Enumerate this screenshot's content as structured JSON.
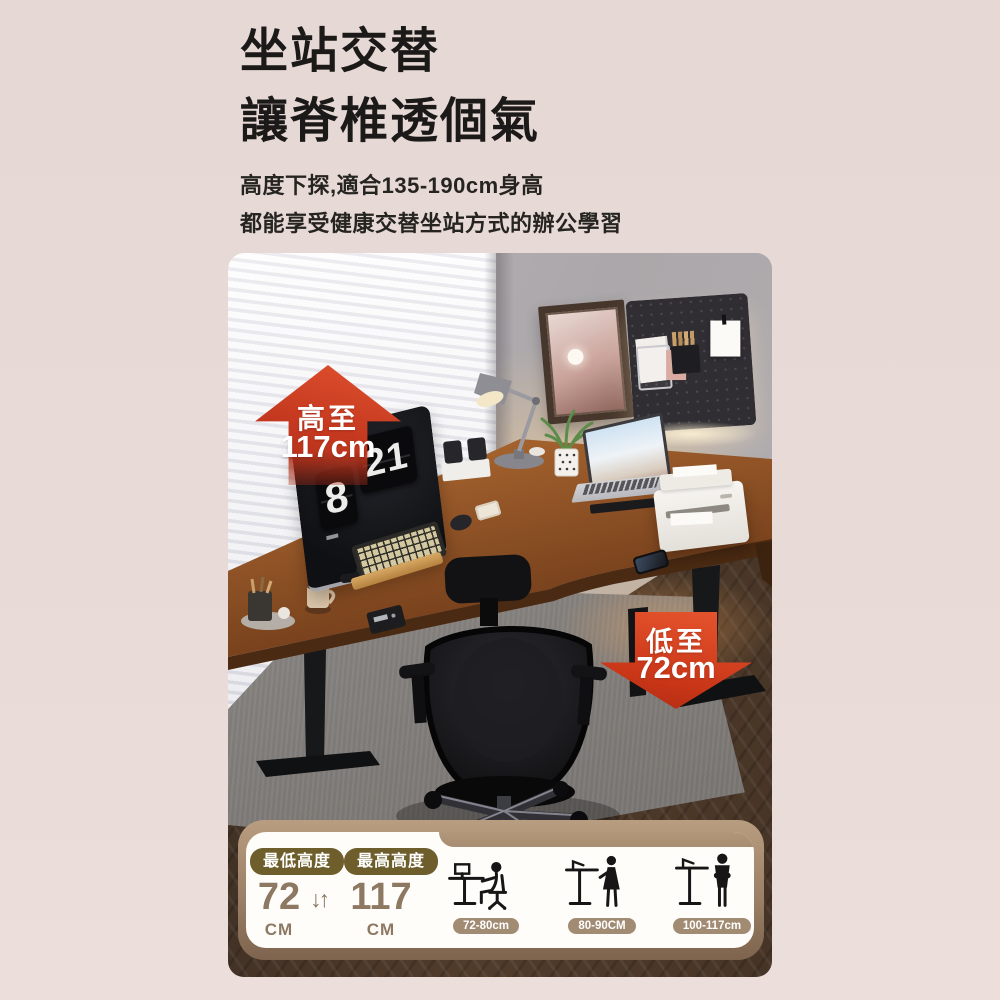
{
  "header": {
    "title_line1": "坐站交替",
    "title_line2": "讓脊椎透個氣",
    "subtitle_line1": "高度下探,適合135-190cm身高",
    "subtitle_line2": "都能享受健康交替坐站方式的辦公學習"
  },
  "photo": {
    "badge_high": {
      "label": "高至",
      "value": "117cm"
    },
    "badge_low": {
      "label": "低至",
      "value": "72cm"
    },
    "flip_clock": {
      "hour": "8",
      "minute": "21"
    }
  },
  "panel": {
    "min": {
      "badge": "最低高度",
      "value": "72",
      "unit": "CM"
    },
    "max": {
      "badge": "最高高度",
      "value": "117",
      "unit": "CM"
    },
    "updown_icon": "↓↑",
    "ranges": [
      {
        "label": "72-80cm",
        "pose": "sitting"
      },
      {
        "label": "80-90CM",
        "pose": "standing-female"
      },
      {
        "label": "100-117cm",
        "pose": "standing-male"
      }
    ]
  },
  "colors": {
    "accent_red": "#c4381f",
    "panel_tan": "#a78d71",
    "pill_olive": "#6d5e2b",
    "value_brown": "#8d7962",
    "desk_wood": "#8a4f24",
    "page_bg": "#e8dad6"
  }
}
